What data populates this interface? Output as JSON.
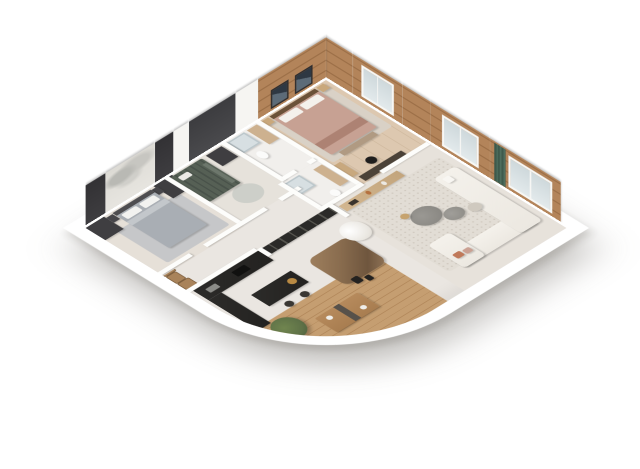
{
  "scene": {
    "description": "3D isometric cutaway render of an apartment floor plan on a white background",
    "view": "isometric-top",
    "background": "#ffffff"
  },
  "palette": {
    "floor": "#eae6e1",
    "wood": "#b3845a",
    "wooddark": "#9d7048",
    "deck": "#c59e71",
    "charcoal": "#232220",
    "wardrobe": "#3f3e41",
    "kidswall": "#4b4b4e",
    "curtain": "#3e5a4c",
    "bedgray": "#a9aeb4",
    "bedpink": "#c7a193",
    "sofa": "#ece8e1",
    "ruglight": "#e2ddd5",
    "ruggray": "#c6c7c9",
    "marble": "#8a6d4f",
    "chairwood": "#a9835a",
    "tan": "#cdb18f",
    "skyglass": "#e3eaec",
    "plantgreen": "#5e7147",
    "terracotta": "#c0795a"
  },
  "rooms": [
    {
      "id": "bedroom-1",
      "label": "Bedroom",
      "furniture": [
        "double bed with gray duvet",
        "two dark wardrobe towers",
        "nightstands",
        "gray area rug",
        "mountain sketch mural wall"
      ]
    },
    {
      "id": "kids-bedroom",
      "label": "Kids bedroom",
      "furniture": [
        "green bunk bed",
        "wardrobe",
        "round rug",
        "dark accent wall"
      ]
    },
    {
      "id": "bathroom-1",
      "label": "Bathroom",
      "furniture": [
        "shower",
        "vanity",
        "toilet"
      ]
    },
    {
      "id": "master-bedroom",
      "label": "Master bedroom",
      "furniture": [
        "double bed with blush duvet",
        "two framed artworks",
        "nightstands",
        "desk with chair",
        "dresser",
        "wood plank walls",
        "windows"
      ]
    },
    {
      "id": "bathroom-2",
      "label": "En-suite bathroom",
      "furniture": [
        "shower",
        "vanity",
        "toilet"
      ]
    },
    {
      "id": "hallway",
      "label": "Hallway",
      "furniture": []
    },
    {
      "id": "kitchen",
      "label": "Kitchen",
      "furniture": [
        "black counter run",
        "black island with gold sink",
        "two bar stools",
        "tall black cabinets"
      ]
    },
    {
      "id": "dining-area",
      "label": "Dining area",
      "furniture": [
        "brown marble dining table",
        "five white wire chairs",
        "white hanging chair",
        "dark glass partition"
      ]
    },
    {
      "id": "living-room",
      "label": "Living room",
      "furniture": [
        "white corner sofa",
        "organic gray coffee tables",
        "travertine sideboard",
        "speckled rug",
        "green curtains",
        "large windows",
        "pouf",
        "terracotta cushions"
      ]
    },
    {
      "id": "terrace",
      "label": "Curved terrace",
      "furniture": [
        "wood deck",
        "outdoor dining table",
        "five wooden chairs",
        "potted plant",
        "two black lanterns",
        "curved white parapet"
      ]
    }
  ]
}
